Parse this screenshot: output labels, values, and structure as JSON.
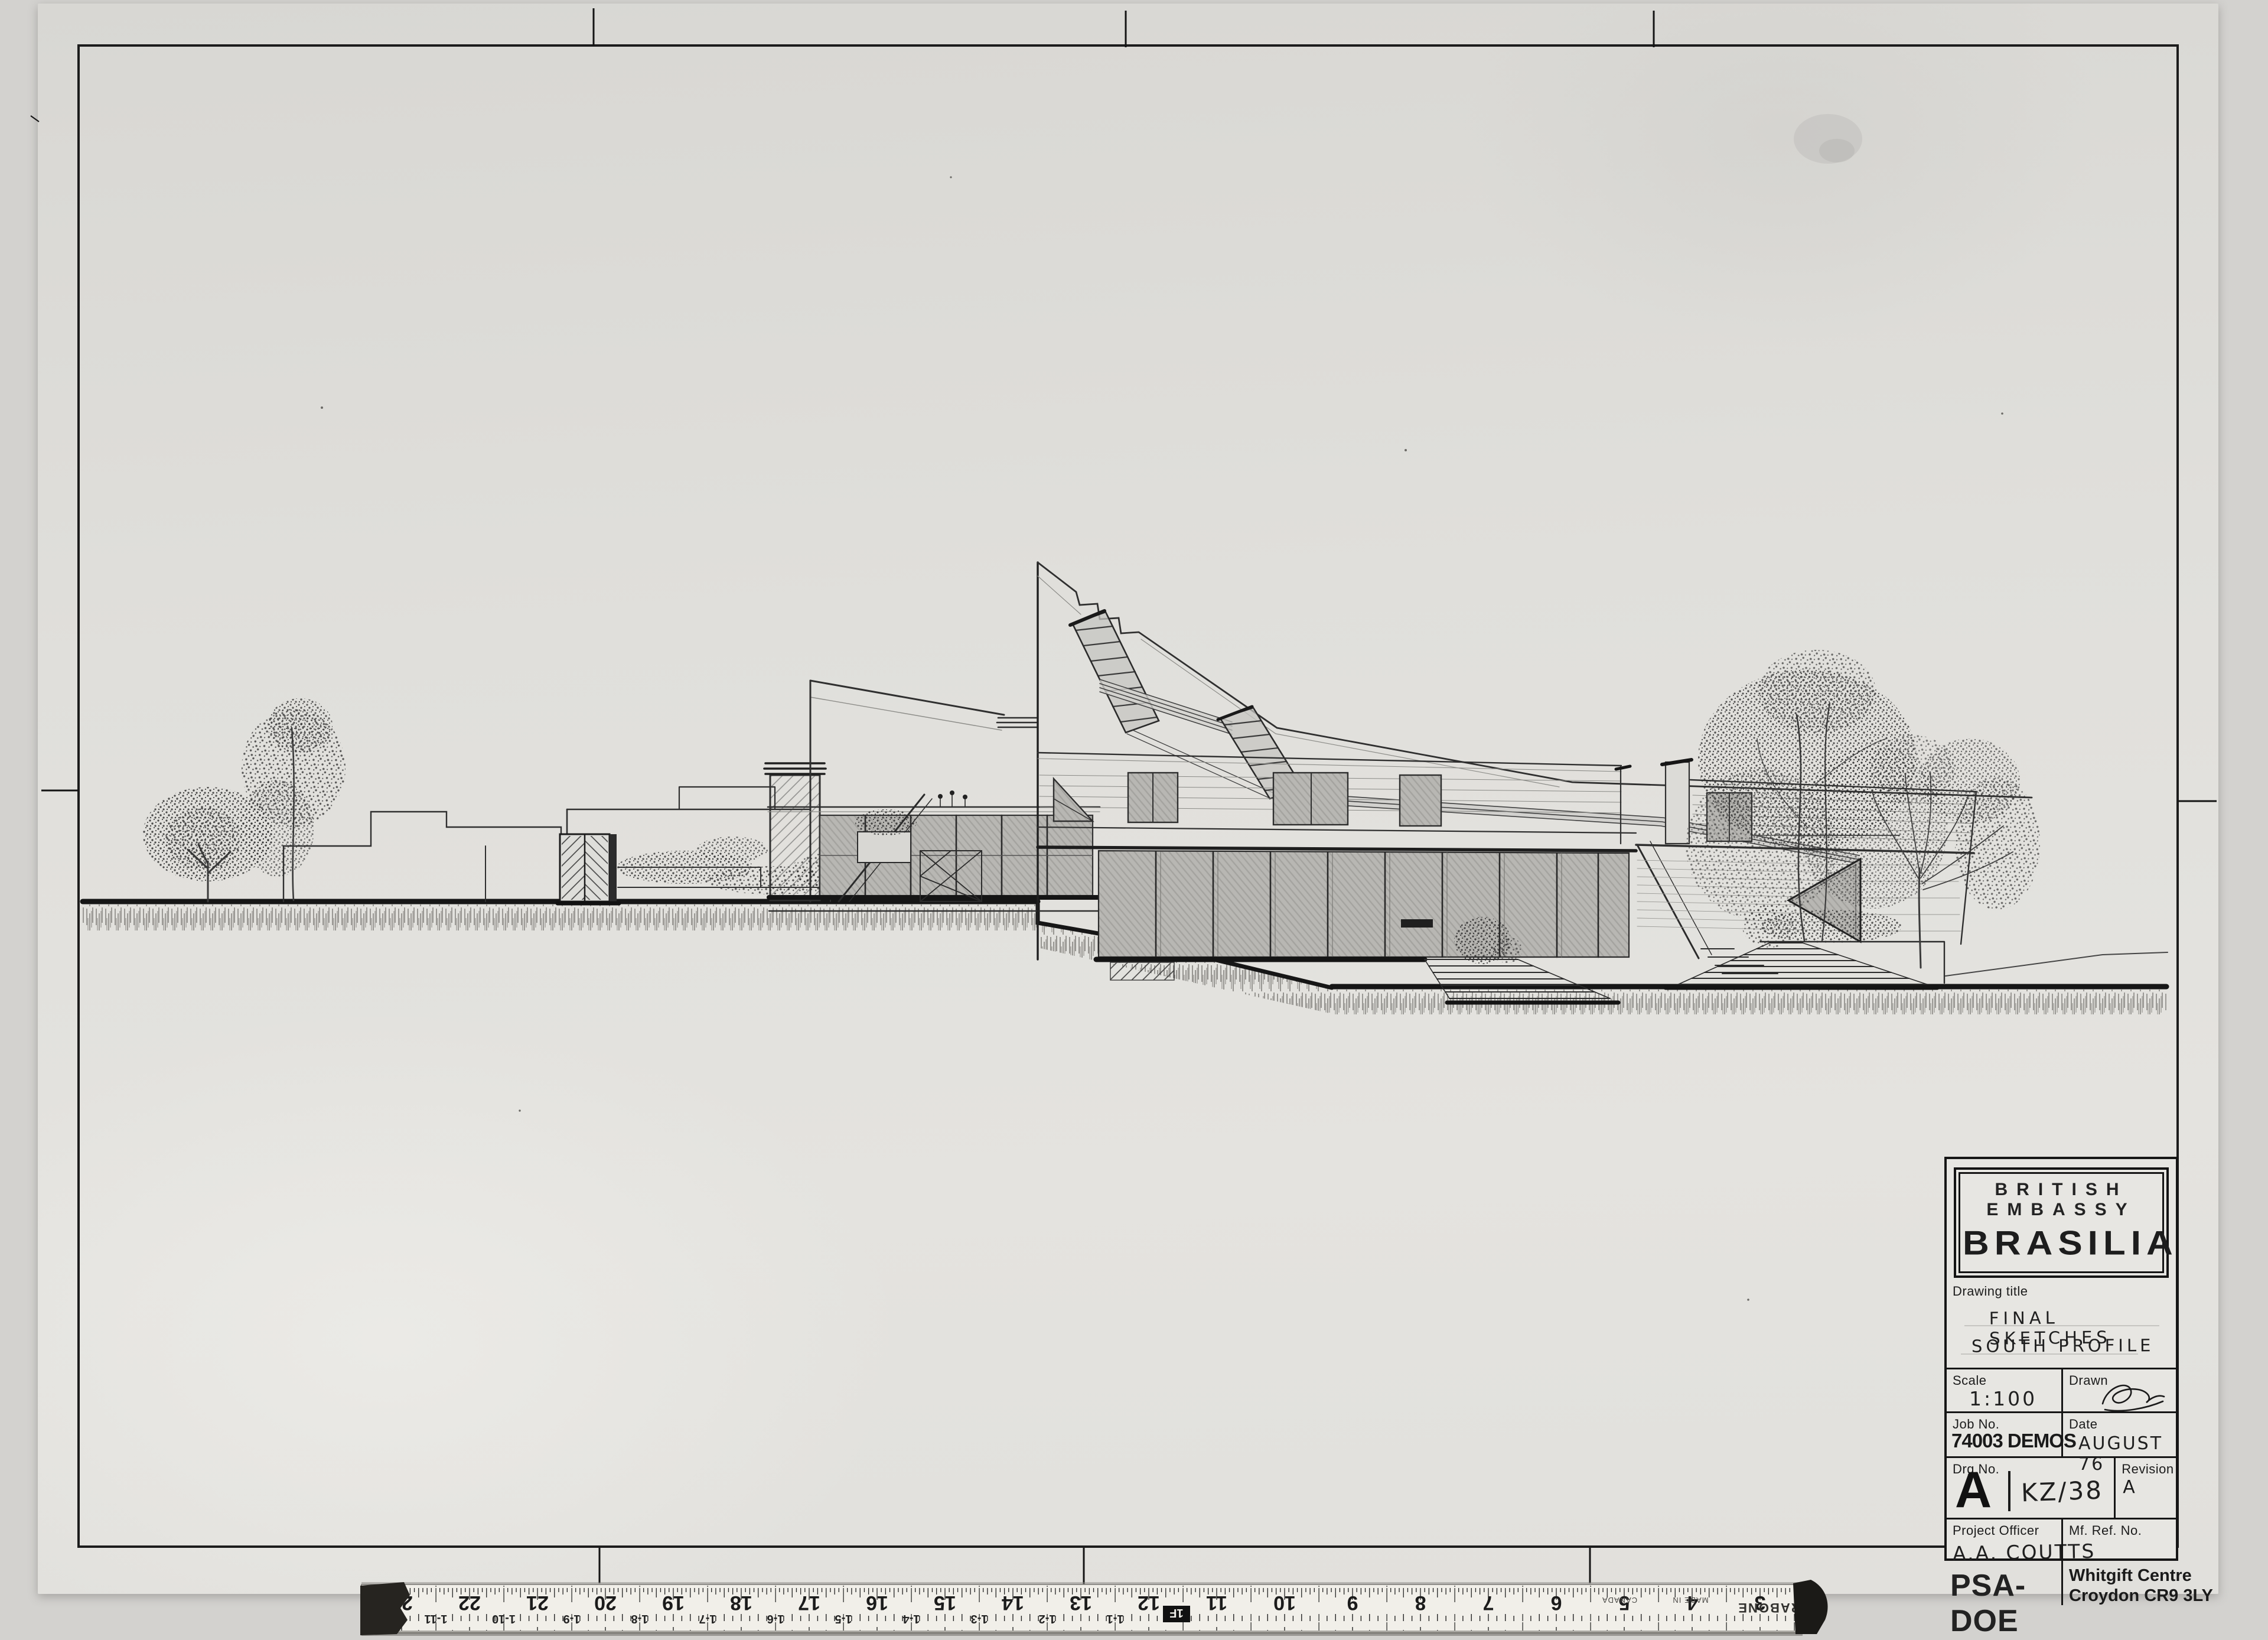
{
  "title_block": {
    "agency_line1": "BRITISH EMBASSY",
    "agency_line2": "BRASILIA",
    "drawing_title_label": "Drawing title",
    "drawing_title_line1": "FINAL SKETCHES",
    "drawing_title_line2": "SOUTH PROFILE",
    "scale_label": "Scale",
    "scale_value": "1:100",
    "drawn_label": "Drawn",
    "job_no_label": "Job No.",
    "job_no_value": "74003 DEMOS",
    "date_label": "Date",
    "date_value": "AUGUST 76",
    "drg_no_label": "Drg.No.",
    "drg_no_prefix": "A",
    "drg_no_value": "KZ/38",
    "revision_label": "Revision",
    "revision_value": "A",
    "project_officer_label": "Project Officer",
    "project_officer_value": "A.A. COUTTS",
    "organisation": "PSA-DOE",
    "mf_ref_label": "Mf. Ref. No.",
    "mf_ref_line1": "Whitgift Centre",
    "mf_ref_line2": "Croydon CR9 3LY"
  },
  "ruler": {
    "brand": "RABONE",
    "origin_line1": "MADE IN",
    "origin_line2": "CANADA",
    "marks": [
      {
        "in": "23",
        "ft": "1-11"
      },
      {
        "in": "22",
        "ft": "1-10"
      },
      {
        "in": "21",
        "ft": "1-9"
      },
      {
        "in": "20",
        "ft": "1-8"
      },
      {
        "in": "19",
        "ft": "1-7"
      },
      {
        "in": "18",
        "ft": "1-6"
      },
      {
        "in": "17",
        "ft": "1-5"
      },
      {
        "in": "16",
        "ft": "1-4"
      },
      {
        "in": "15",
        "ft": "1-3"
      },
      {
        "in": "14",
        "ft": "1-2"
      },
      {
        "in": "13",
        "ft": "1-1"
      },
      {
        "in": "12",
        "ft": "1F"
      },
      {
        "in": "11"
      },
      {
        "in": "10"
      },
      {
        "in": "9"
      },
      {
        "in": "8"
      },
      {
        "in": "7"
      },
      {
        "in": "6"
      },
      {
        "in": "5"
      },
      {
        "in": "4"
      },
      {
        "in": "3"
      }
    ]
  },
  "colors": {
    "paper": "#e2e1dd",
    "scanner_background": "#d3d2cf",
    "ink": "#2f2f2f",
    "heavy_ink": "#141414",
    "pencil_shade": "#b5b4b0"
  }
}
